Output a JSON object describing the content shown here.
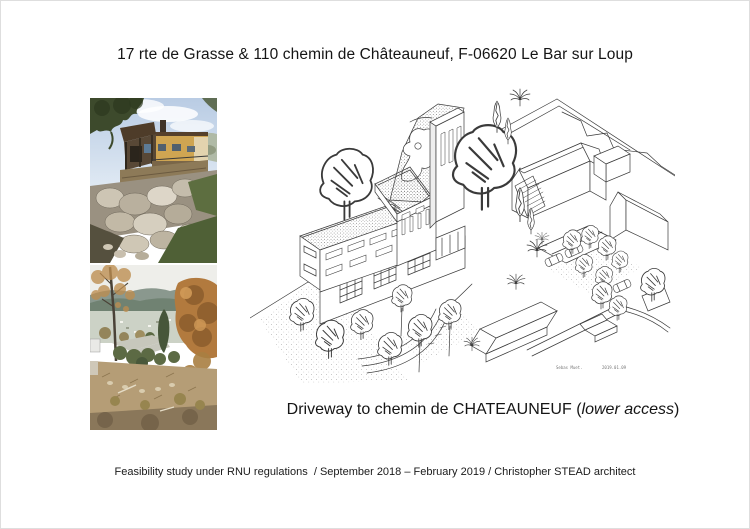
{
  "page": {
    "title": "17 rte de Grasse & 110 chemin de Châteauneuf, F-06620 Le Bar sur Loup",
    "caption_prefix": "Driveway to chemin de CHATEAUNEUF (",
    "caption_italic": "lower access",
    "caption_suffix": ")",
    "footer": "Feasibility study under RNU regulations  / September 2018 – February 2019 / Christopher STEAD architect"
  },
  "drawing": {
    "signature": "Sebas Muet.",
    "date": "2019.01.09"
  },
  "colors": {
    "page_background": "#ffffff",
    "ink": "#3a3a3a",
    "text": "#151515",
    "photo1_sky": "#c3d2e6",
    "photo1_house": "#cfa552",
    "photo1_rocks": "#c6beae",
    "photo2_mountain": "#6e8070",
    "photo2_autumn_foliage": "#b27a3e",
    "photo2_ground": "#b59d76"
  }
}
